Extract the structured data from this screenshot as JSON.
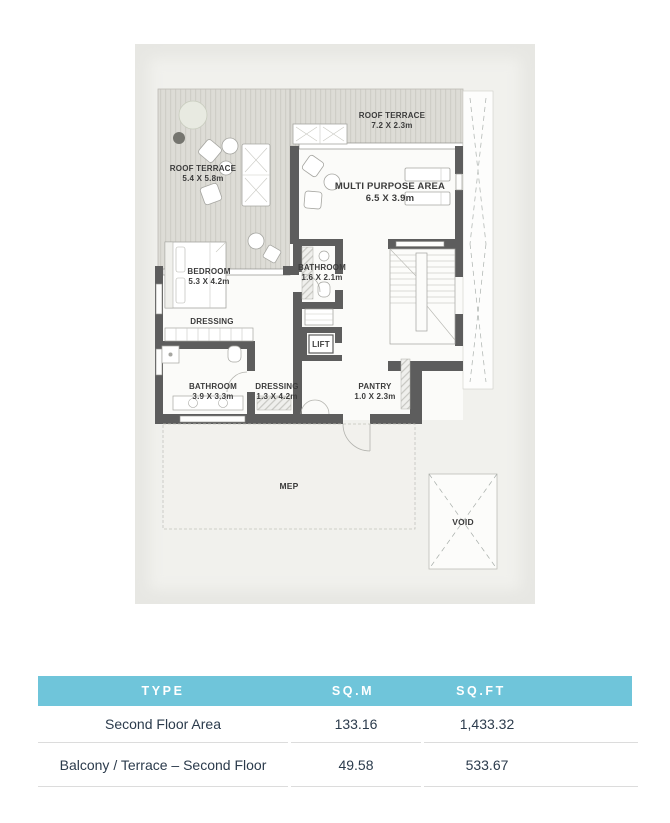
{
  "floor_plan": {
    "rooms": {
      "roof_terrace_top": {
        "name": "ROOF TERRACE",
        "dims": "7.2 X 2.3m"
      },
      "roof_terrace_left": {
        "name": "ROOF TERRACE",
        "dims": "5.4 X 5.8m"
      },
      "multi_purpose": {
        "name": "MULTI PURPOSE AREA",
        "dims": "6.5 X 3.9m"
      },
      "bedroom": {
        "name": "BEDROOM",
        "dims": "5.3 X 4.2m"
      },
      "bathroom_small": {
        "name": "BATHROOM",
        "dims": "1.6 X 2.1m"
      },
      "dressing_upper": {
        "name": "DRESSING"
      },
      "lift": {
        "name": "LIFT"
      },
      "bathroom_main": {
        "name": "BATHROOM",
        "dims": "3.9 X 3.3m"
      },
      "dressing_lower": {
        "name": "DRESSING",
        "dims": "1.3 X 4.2m"
      },
      "pantry": {
        "name": "PANTRY",
        "dims": "1.0 X 2.3m"
      },
      "mep": {
        "name": "MEP"
      },
      "void": {
        "name": "VOID"
      }
    }
  },
  "table": {
    "headers": [
      "TYPE",
      "SQ.M",
      "SQ.FT"
    ],
    "rows": [
      {
        "type": "Second Floor Area",
        "sqm": "133.16",
        "sqft": "1,433.32"
      },
      {
        "type": "Balcony / Terrace – Second Floor",
        "sqm": "49.58",
        "sqft": "533.67"
      }
    ]
  },
  "colors": {
    "header_bg": "#6FC5DA",
    "header_text": "#FFFFFF",
    "body_text": "#2B3B4C",
    "divider": "#DCDCDC",
    "wall": "#5D5D5D",
    "deck": "#DDDCD6",
    "paper": "#E7E7E3"
  }
}
